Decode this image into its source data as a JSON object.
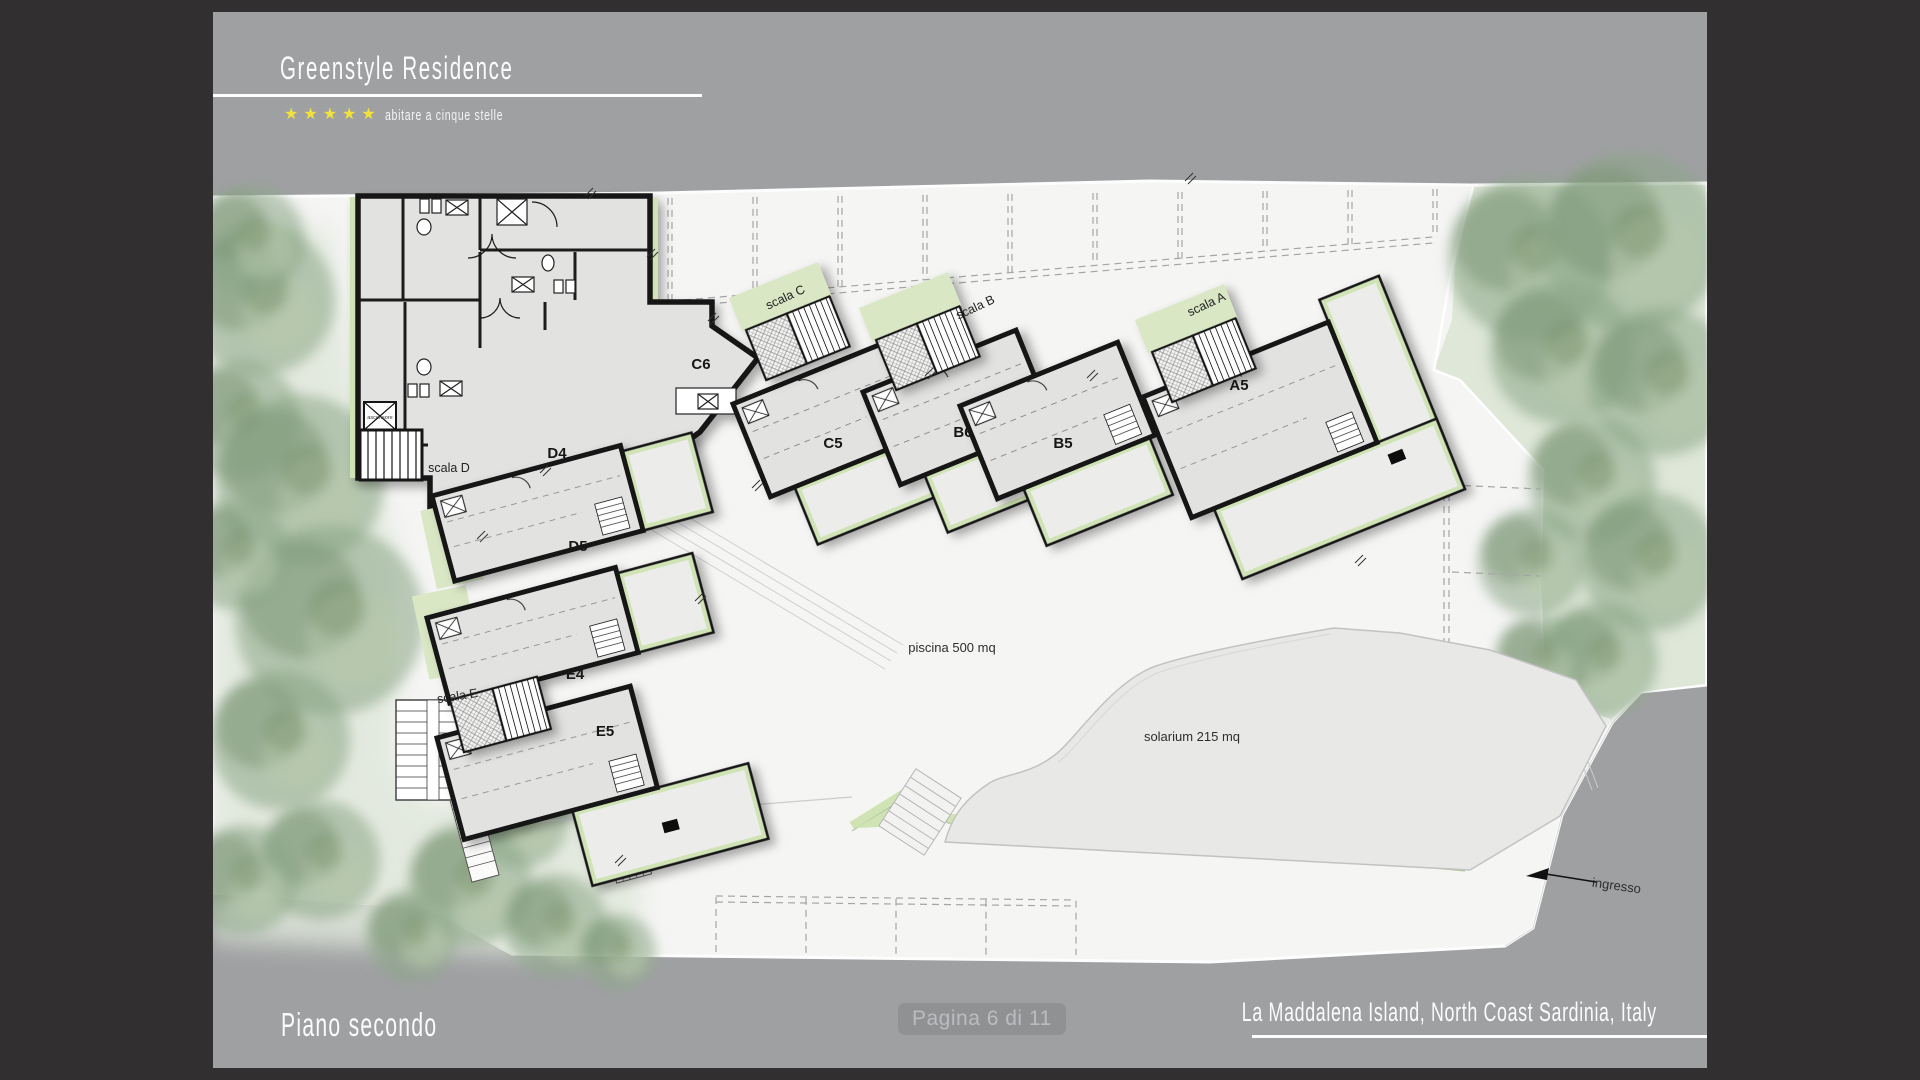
{
  "header": {
    "title": "Greenstyle Residence",
    "tagline": "abitare a cinque stelle",
    "stars": 5,
    "star_icon": "★"
  },
  "footer": {
    "floor_label": "Piano secondo",
    "page_indicator": "Pagina 6 di 11",
    "location": "La Maddalena Island, North Coast Sardinia, Italy"
  },
  "plan": {
    "labels": [
      {
        "kind": "unit",
        "text": "C6",
        "x": 701,
        "y": 369
      },
      {
        "kind": "unit",
        "text": "D4",
        "x": 557,
        "y": 458
      },
      {
        "kind": "unit",
        "text": "C5",
        "x": 833,
        "y": 448
      },
      {
        "kind": "unit",
        "text": "B6",
        "x": 963,
        "y": 437
      },
      {
        "kind": "unit",
        "text": "B5",
        "x": 1063,
        "y": 448
      },
      {
        "kind": "unit",
        "text": "A5",
        "x": 1239,
        "y": 390
      },
      {
        "kind": "unit",
        "text": "D5",
        "x": 578,
        "y": 551
      },
      {
        "kind": "unit",
        "text": "E4",
        "x": 575,
        "y": 679
      },
      {
        "kind": "unit",
        "text": "E5",
        "x": 605,
        "y": 736
      },
      {
        "kind": "stair",
        "text": "scala A",
        "x": 1208,
        "y": 308,
        "rot": -25
      },
      {
        "kind": "stair",
        "text": "scala B",
        "x": 977,
        "y": 311,
        "rot": -25
      },
      {
        "kind": "stair",
        "text": "scala C",
        "x": 787,
        "y": 301,
        "rot": -25
      },
      {
        "kind": "stair",
        "text": "scala D",
        "x": 449,
        "y": 472,
        "rot": 0
      },
      {
        "kind": "stair",
        "text": "scala E",
        "x": 458,
        "y": 700,
        "rot": -9
      },
      {
        "kind": "area",
        "text": "piscina 500 mq",
        "x": 952,
        "y": 652,
        "rot": 0
      },
      {
        "kind": "area",
        "text": "solarium 215 mq",
        "x": 1192,
        "y": 741,
        "rot": 0
      },
      {
        "kind": "area",
        "text": "ingresso",
        "x": 1616,
        "y": 890,
        "rot": 8
      },
      {
        "kind": "tiny",
        "text": "ascensore",
        "x": 380,
        "y": 419,
        "rot": 0
      }
    ],
    "colors": {
      "frame": "#312f2f",
      "band": "#9fa0a2",
      "site": "#f5f5f4",
      "building": "#e2e2e1",
      "terrace": "#ececeb",
      "wall": "#141414",
      "green_accent": "#cfe3b4",
      "lawn": "#d8e3d0",
      "solarium": "#e8e8e7",
      "star": "#f2e13b"
    }
  }
}
